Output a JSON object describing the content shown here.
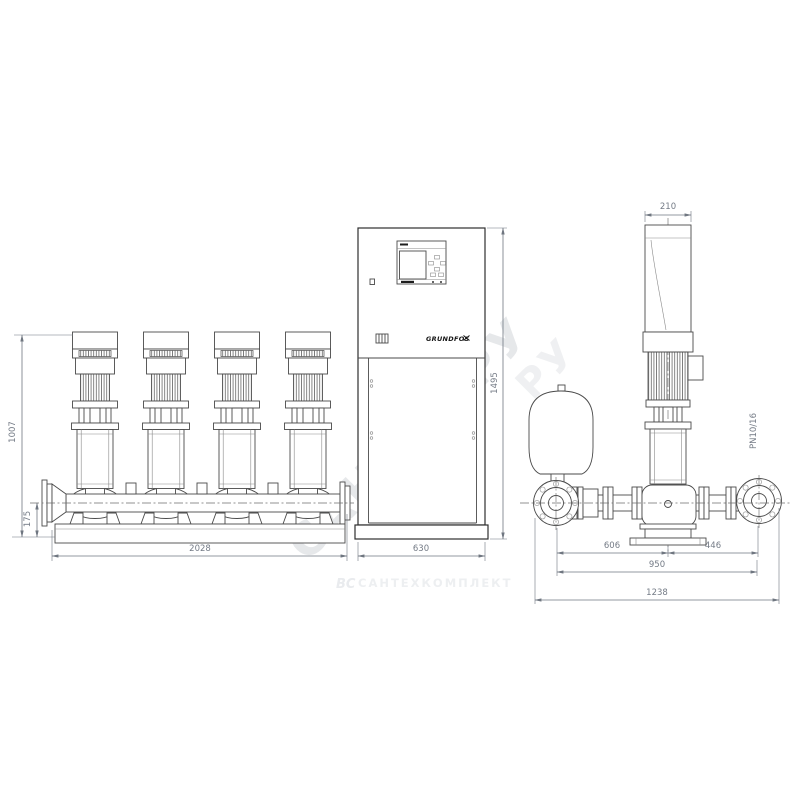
{
  "front_view": {
    "dimensions": {
      "pump_height": "1007",
      "manifold_center_height": "175",
      "skid_length": "2028",
      "cabinet_width": "630",
      "cabinet_height": "1495"
    },
    "cabinet": {
      "brand_logo": "GRUNDFOS"
    }
  },
  "side_view": {
    "dimensions": {
      "motor_shroud_width": "210",
      "center_to_suction": "606",
      "center_to_discharge": "446",
      "flange_to_flange": "950",
      "overall_depth": "1238"
    },
    "flange_pressure_rating": "PN10/16"
  },
  "watermarks": {
    "diagonal_main": "САНТЕХ.РУ",
    "diagonal_fragment": "РУ",
    "footer_logo": "ВС",
    "footer_name": "САНТЕХКОМПЛЕКТ"
  }
}
